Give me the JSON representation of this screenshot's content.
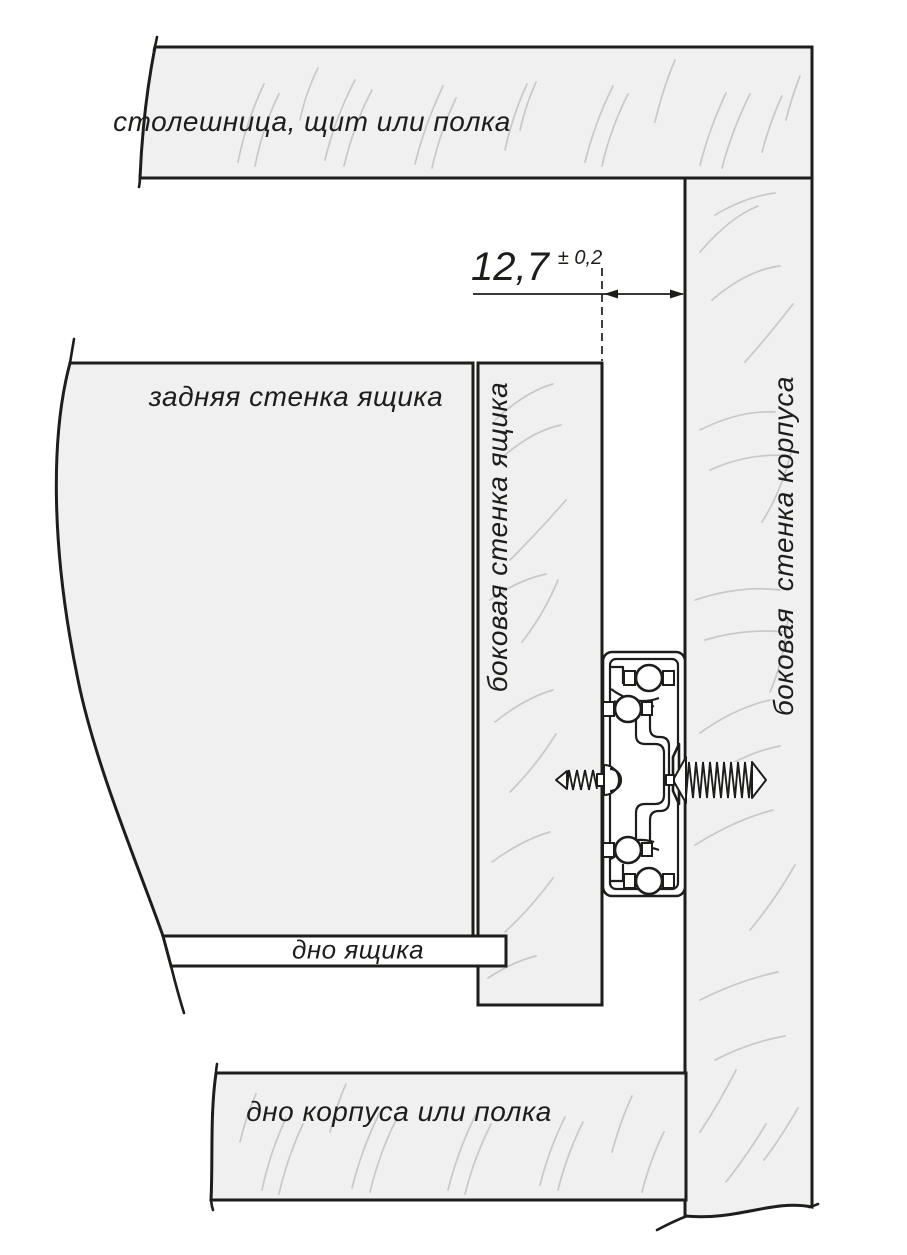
{
  "diagram": {
    "labels": {
      "top_panel": "столешница, щит или полка",
      "back_wall": "задняя стенка ящика",
      "drawer_side_wall": "боковая стенка ящика",
      "cabinet_side_wall": "боковая  стенка корпуса",
      "drawer_bottom": "дно ящика",
      "cabinet_bottom": "дно корпуса или полка"
    },
    "dimension": {
      "value": "12,7",
      "tolerance": "± 0,2"
    },
    "colors": {
      "panel_fill": "#f0f0f1",
      "line": "#1d1d1b",
      "grain": "#c8c8c8",
      "background": "#ffffff"
    }
  }
}
